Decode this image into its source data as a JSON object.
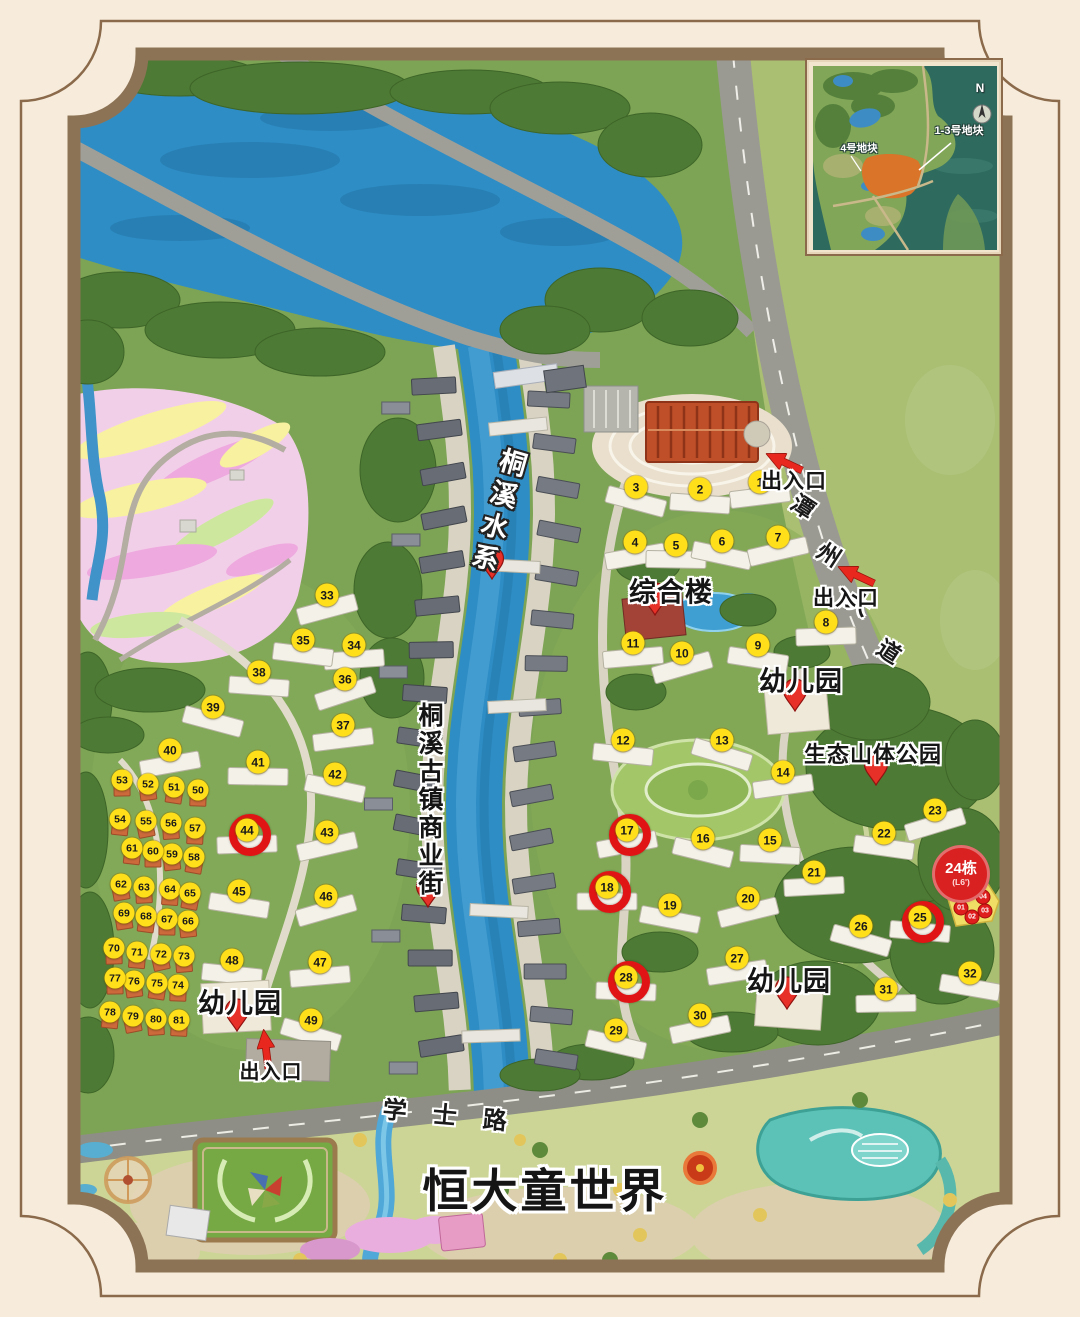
{
  "inset_map": {
    "north_label": "N",
    "plot_1_3_label": "1-3号地块",
    "plot_4_label": "4号地块"
  },
  "labels": {
    "water_system": "桐溪水系",
    "complex_building": "综合楼",
    "kindergarten": "幼儿园",
    "eco_mountain_park": "生态山体公园",
    "ancient_town_street": "桐溪古镇商业街",
    "entrance": "出入口",
    "tanzhou_avenue_chars": [
      "潭",
      "州",
      "大",
      "道"
    ],
    "xueshi_road_chars": [
      "学",
      "士",
      "路"
    ],
    "theme_park_title": "恒大童世界"
  },
  "highlight": {
    "building24_label": "24栋",
    "building24_floor": "(L6')",
    "circled_buildings": [
      17,
      18,
      25,
      28,
      44
    ],
    "units": [
      {
        "label": "01",
        "x": 961,
        "y": 908
      },
      {
        "label": "02",
        "x": 972,
        "y": 917
      },
      {
        "label": "03",
        "x": 985,
        "y": 911
      },
      {
        "label": "04",
        "x": 983,
        "y": 897
      }
    ]
  },
  "markers": {
    "buildings": [
      {
        "n": 1,
        "x": 760,
        "y": 482
      },
      {
        "n": 2,
        "x": 700,
        "y": 489
      },
      {
        "n": 3,
        "x": 636,
        "y": 487
      },
      {
        "n": 4,
        "x": 635,
        "y": 542
      },
      {
        "n": 5,
        "x": 676,
        "y": 545
      },
      {
        "n": 6,
        "x": 722,
        "y": 541
      },
      {
        "n": 7,
        "x": 778,
        "y": 537
      },
      {
        "n": 8,
        "x": 826,
        "y": 622
      },
      {
        "n": 9,
        "x": 758,
        "y": 645
      },
      {
        "n": 10,
        "x": 682,
        "y": 653
      },
      {
        "n": 11,
        "x": 633,
        "y": 643
      },
      {
        "n": 12,
        "x": 623,
        "y": 740
      },
      {
        "n": 13,
        "x": 722,
        "y": 740
      },
      {
        "n": 14,
        "x": 783,
        "y": 772
      },
      {
        "n": 15,
        "x": 770,
        "y": 840
      },
      {
        "n": 16,
        "x": 703,
        "y": 838
      },
      {
        "n": 17,
        "x": 627,
        "y": 830
      },
      {
        "n": 18,
        "x": 607,
        "y": 887
      },
      {
        "n": 19,
        "x": 670,
        "y": 905
      },
      {
        "n": 20,
        "x": 748,
        "y": 898
      },
      {
        "n": 21,
        "x": 814,
        "y": 872
      },
      {
        "n": 22,
        "x": 884,
        "y": 833
      },
      {
        "n": 23,
        "x": 935,
        "y": 810
      },
      {
        "n": 25,
        "x": 920,
        "y": 917
      },
      {
        "n": 26,
        "x": 861,
        "y": 926
      },
      {
        "n": 27,
        "x": 737,
        "y": 958
      },
      {
        "n": 28,
        "x": 626,
        "y": 977
      },
      {
        "n": 29,
        "x": 616,
        "y": 1030
      },
      {
        "n": 30,
        "x": 700,
        "y": 1015
      },
      {
        "n": 31,
        "x": 886,
        "y": 989
      },
      {
        "n": 32,
        "x": 970,
        "y": 973
      },
      {
        "n": 33,
        "x": 327,
        "y": 595
      },
      {
        "n": 34,
        "x": 354,
        "y": 645
      },
      {
        "n": 35,
        "x": 303,
        "y": 640
      },
      {
        "n": 36,
        "x": 345,
        "y": 679
      },
      {
        "n": 37,
        "x": 343,
        "y": 725
      },
      {
        "n": 38,
        "x": 259,
        "y": 672
      },
      {
        "n": 39,
        "x": 213,
        "y": 707
      },
      {
        "n": 40,
        "x": 170,
        "y": 750
      },
      {
        "n": 41,
        "x": 258,
        "y": 762
      },
      {
        "n": 42,
        "x": 335,
        "y": 774
      },
      {
        "n": 43,
        "x": 327,
        "y": 832
      },
      {
        "n": 44,
        "x": 247,
        "y": 830
      },
      {
        "n": 45,
        "x": 239,
        "y": 891
      },
      {
        "n": 46,
        "x": 326,
        "y": 896
      },
      {
        "n": 47,
        "x": 320,
        "y": 962
      },
      {
        "n": 48,
        "x": 232,
        "y": 960
      },
      {
        "n": 49,
        "x": 311,
        "y": 1020
      }
    ],
    "villas": [
      {
        "n": 50,
        "x": 198,
        "y": 790
      },
      {
        "n": 51,
        "x": 174,
        "y": 787
      },
      {
        "n": 52,
        "x": 148,
        "y": 784
      },
      {
        "n": 53,
        "x": 122,
        "y": 780
      },
      {
        "n": 54,
        "x": 120,
        "y": 819
      },
      {
        "n": 55,
        "x": 146,
        "y": 821
      },
      {
        "n": 56,
        "x": 171,
        "y": 823
      },
      {
        "n": 57,
        "x": 195,
        "y": 828
      },
      {
        "n": 58,
        "x": 194,
        "y": 857
      },
      {
        "n": 59,
        "x": 172,
        "y": 854
      },
      {
        "n": 60,
        "x": 153,
        "y": 851
      },
      {
        "n": 61,
        "x": 132,
        "y": 848
      },
      {
        "n": 62,
        "x": 121,
        "y": 884
      },
      {
        "n": 63,
        "x": 144,
        "y": 887
      },
      {
        "n": 64,
        "x": 170,
        "y": 889
      },
      {
        "n": 65,
        "x": 190,
        "y": 893
      },
      {
        "n": 66,
        "x": 188,
        "y": 921
      },
      {
        "n": 67,
        "x": 167,
        "y": 919
      },
      {
        "n": 68,
        "x": 146,
        "y": 916
      },
      {
        "n": 69,
        "x": 124,
        "y": 913
      },
      {
        "n": 70,
        "x": 114,
        "y": 948
      },
      {
        "n": 71,
        "x": 137,
        "y": 952
      },
      {
        "n": 72,
        "x": 161,
        "y": 954
      },
      {
        "n": 73,
        "x": 184,
        "y": 956
      },
      {
        "n": 74,
        "x": 178,
        "y": 985
      },
      {
        "n": 75,
        "x": 157,
        "y": 983
      },
      {
        "n": 76,
        "x": 134,
        "y": 981
      },
      {
        "n": 77,
        "x": 115,
        "y": 978
      },
      {
        "n": 78,
        "x": 110,
        "y": 1012
      },
      {
        "n": 79,
        "x": 133,
        "y": 1016
      },
      {
        "n": 80,
        "x": 156,
        "y": 1019
      },
      {
        "n": 81,
        "x": 179,
        "y": 1020
      }
    ]
  },
  "colors": {
    "marker_yellow": "#ffdf1a",
    "highlight_red": "#e01414",
    "pin_red": "#e73027",
    "water_blue": "#2e8dc5",
    "frame_brown": "#8d7356"
  }
}
